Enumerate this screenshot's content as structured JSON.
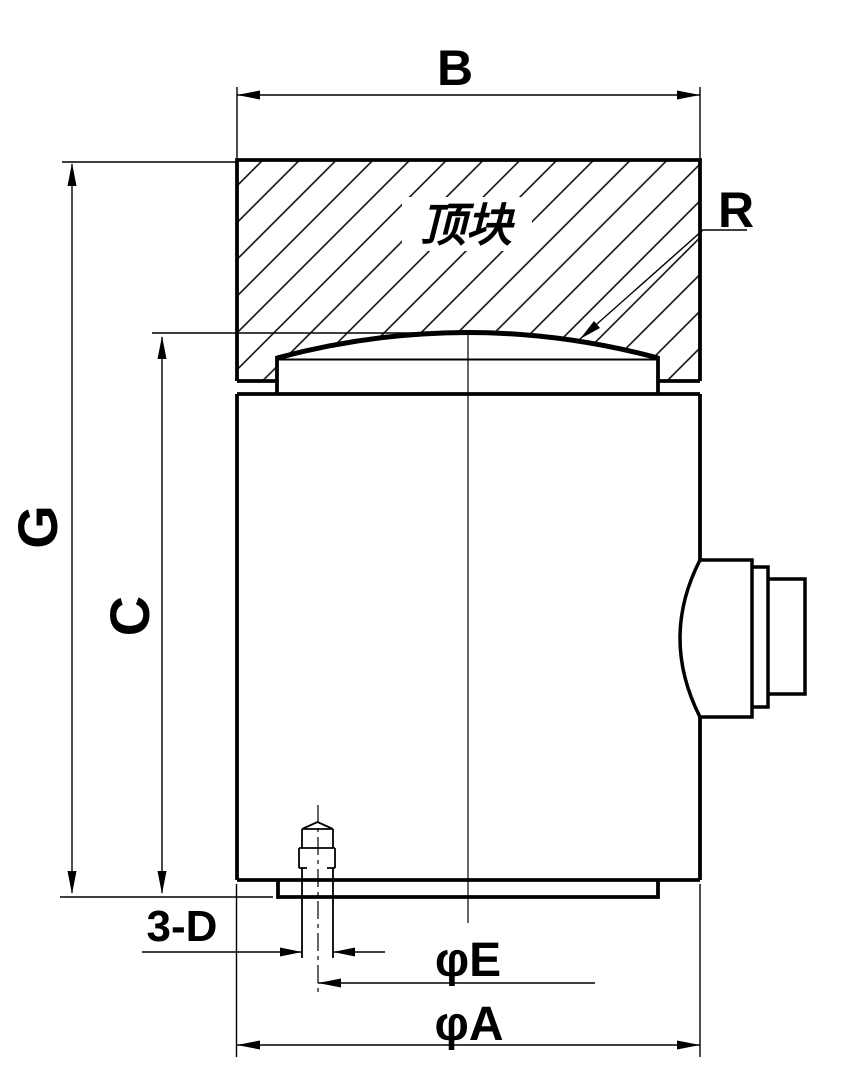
{
  "drawing": {
    "type": "engineering-dimension-drawing",
    "subject": "column load cell with top block",
    "annotations": {
      "top_block": "顶块",
      "dim_top_block_width": "B",
      "dim_sphere_radius": "R",
      "dim_overall_height": "G",
      "dim_cell_height": "C",
      "dim_mounting_holes": "3-D",
      "dim_bolt_circle": "φE",
      "dim_outer_diameter": "φA"
    },
    "colors": {
      "line": "#000000",
      "background": "#ffffff"
    }
  }
}
